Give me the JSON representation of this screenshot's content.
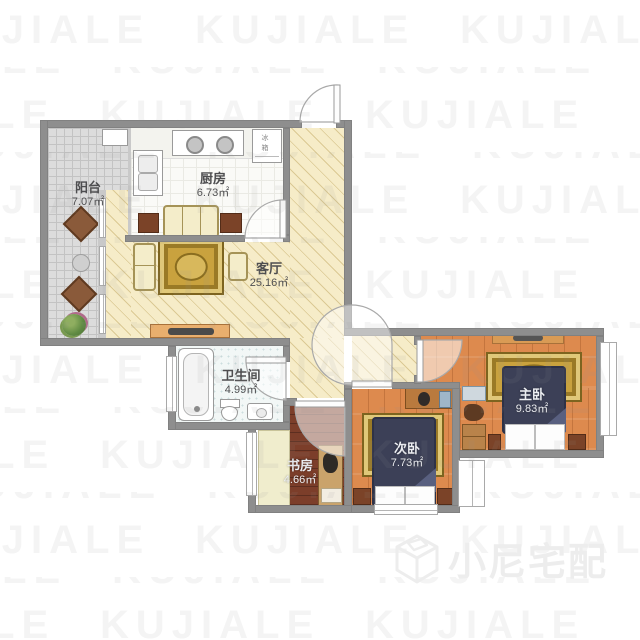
{
  "meta": {
    "brand": "小尼宅配",
    "watermark": "KUJIALE"
  },
  "rooms": [
    {
      "id": "balcony",
      "name": "阳台",
      "area": "7.07㎡"
    },
    {
      "id": "kitchen",
      "name": "厨房",
      "area": "6.73㎡"
    },
    {
      "id": "living",
      "name": "客厅",
      "area": "25.16㎡"
    },
    {
      "id": "bathroom",
      "name": "卫生间",
      "area": "4.99㎡"
    },
    {
      "id": "study",
      "name": "书房",
      "area": "4.66㎡"
    },
    {
      "id": "bedroom2",
      "name": "次卧",
      "area": "7.73㎡"
    },
    {
      "id": "master",
      "name": "主卧",
      "area": "9.83㎡"
    }
  ],
  "labels": {
    "fridge": "冰箱"
  }
}
